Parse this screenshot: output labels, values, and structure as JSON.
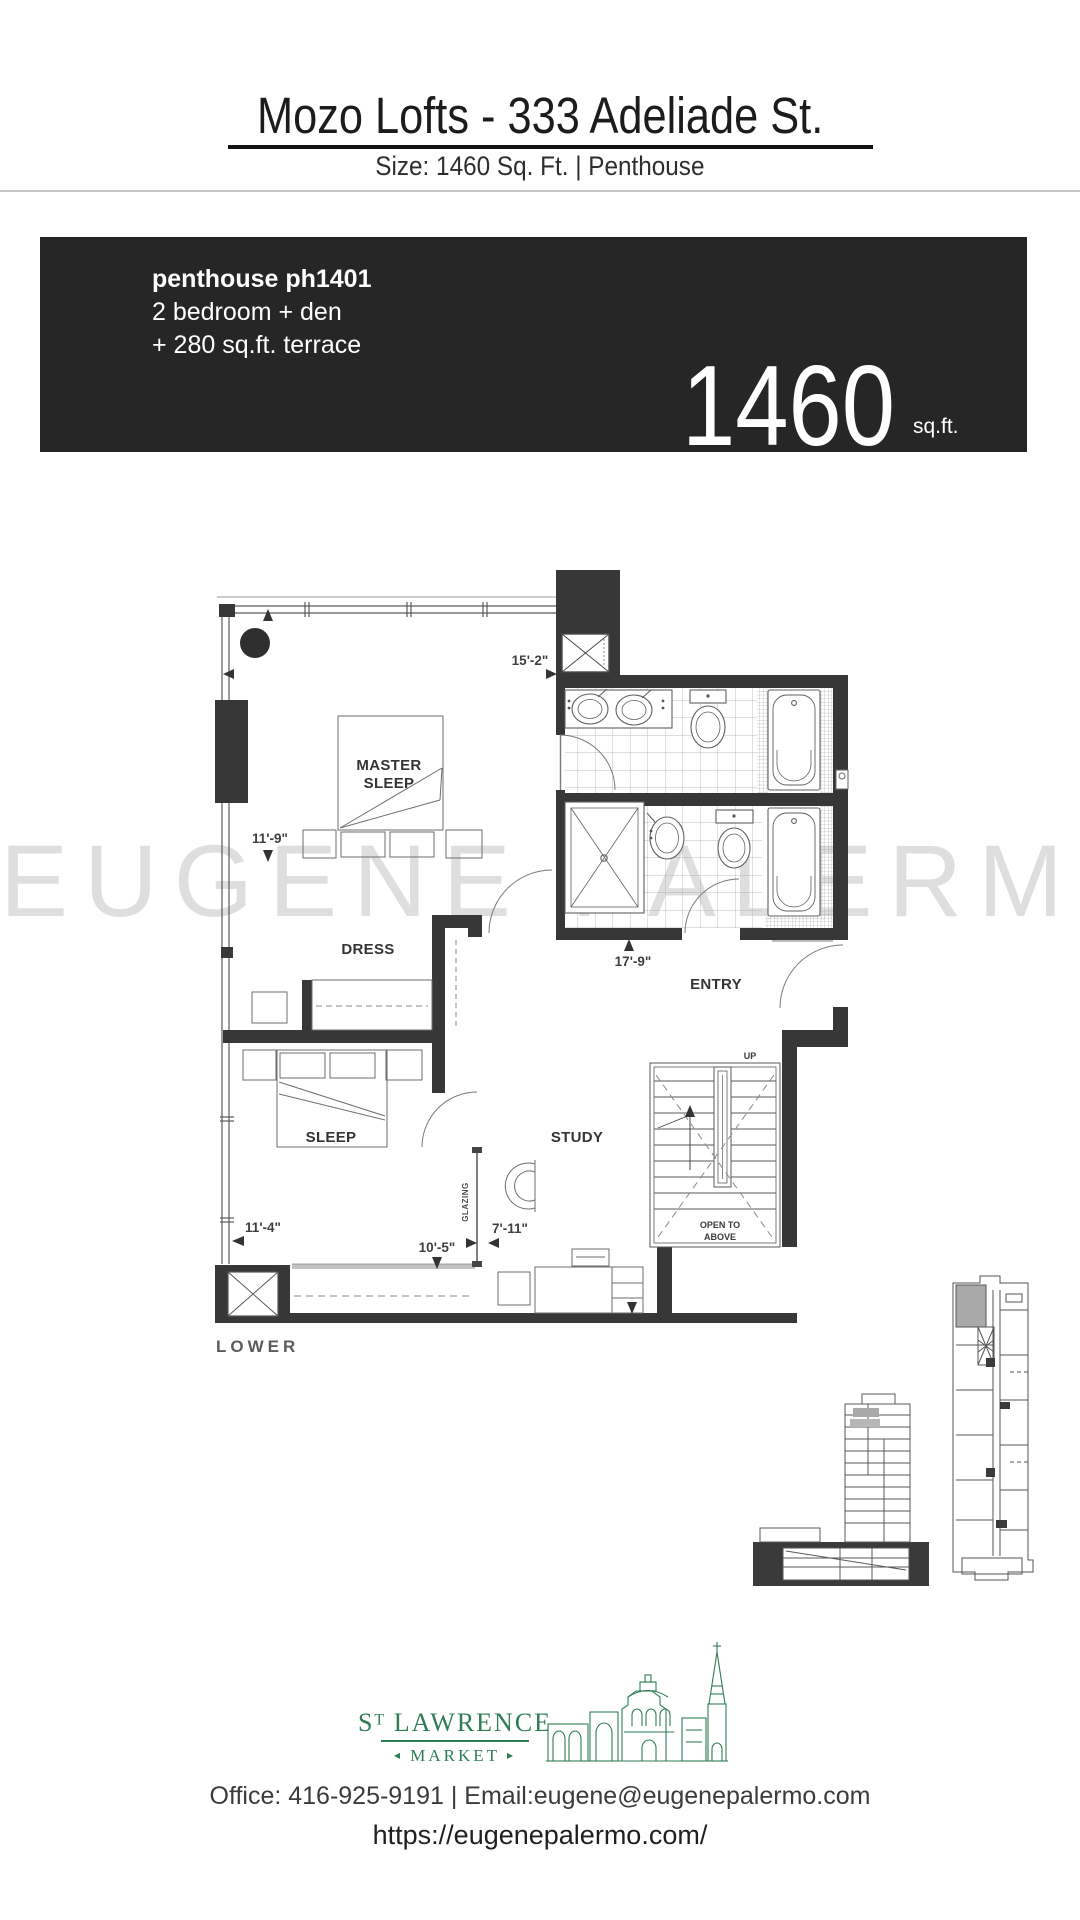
{
  "header": {
    "title": "Mozo Lofts - 333 Adeliade St.",
    "subtitle": "Size: 1460 Sq. Ft. |  Penthouse"
  },
  "unit_card": {
    "name": "penthouse ph1401",
    "bedrooms": "2 bedroom + den",
    "terrace": "+ 280 sq.ft. terrace",
    "area": "1460",
    "area_unit": "sq.ft."
  },
  "floorplan": {
    "watermark": "EUGENE PALERMO",
    "level": "LOWER",
    "rooms": {
      "master_line1": "MASTER",
      "master_line2": "SLEEP",
      "dress": "DRESS",
      "sleep": "SLEEP",
      "study": "STUDY",
      "entry": "ENTRY"
    },
    "stairs": {
      "up": "UP",
      "open_line1": "OPEN TO",
      "open_line2": "ABOVE"
    },
    "glazing": "GLAZING",
    "dimensions": {
      "master_width": "15'-2\"",
      "master_depth": "11'-9\"",
      "hall": "17'-9\"",
      "sleep_width": "11'-4\"",
      "sill": "10'-5\"",
      "study_width": "7'-11\""
    }
  },
  "footer": {
    "brand": {
      "prefix": "S",
      "superscript": "T",
      "name": " LAWRENCE",
      "sub": "MARKET",
      "arrow_left": "◂",
      "arrow_right": "▸"
    },
    "contact": "Office: 416-925-9191  |  Email:eugene@eugenepalermo.com",
    "website": "https://eugenepalermo.com/"
  },
  "colors": {
    "card_bg": "#262626",
    "wall": "#373737",
    "watermark": "#c4c4c4",
    "accent_green": "#2f7d54"
  }
}
